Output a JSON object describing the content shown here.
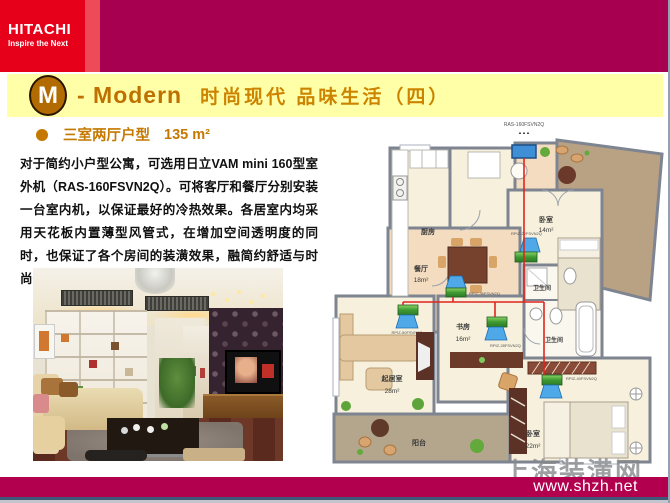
{
  "header": {
    "logo": {
      "brand": "HITACHI",
      "tagline": "Inspire the Next"
    },
    "badge_letter": "M",
    "title_en": "- Modern",
    "title_cn": "时尚现代 品味生活（四）"
  },
  "subtitle": {
    "label": "三室两厅户型",
    "area": "135 m²"
  },
  "paragraph": {
    "text": "对于简约小户型公寓，可选用日立VAM mini 160型室外机（RAS-160FSVN2Q）。可将客厅和餐厅分别安装一台室内机，以保证最好的冷热效果。各居室内均采用天花板内置薄型风管式，在增加空间透明度的同时，也保证了各个房间的装潢效果，融简约舒适与时尚于一体。"
  },
  "floorplan": {
    "rooms": {
      "kitchen": {
        "name": "厨房",
        "area": ""
      },
      "bedroom1": {
        "name": "卧室",
        "area": "14m²"
      },
      "dining": {
        "name": "餐厅",
        "area": "18m²"
      },
      "study": {
        "name": "书房",
        "area": "16m²"
      },
      "living": {
        "name": "起居室",
        "area": "28m²"
      },
      "bath1": {
        "name": "卫生间",
        "area": ""
      },
      "bath2": {
        "name": "卫生间",
        "area": ""
      },
      "bedroom2": {
        "name": "卧室",
        "area": "22m²"
      },
      "balcony": {
        "name": "阳台",
        "area": ""
      }
    },
    "units": {
      "outdoor": {
        "model": "RAS-160FSVN2Q",
        "arrows": "▲▲▲"
      },
      "bedroom1": "RPIZ-22FSVN2Q",
      "dining": "RPIZ-36FSVN2Q",
      "living": "RPIZ-50FSVN2Q",
      "study": "RPIZ-28FSVN2Q",
      "bedroom2": "RPIZ-40FSVN2Q"
    }
  },
  "footer": {
    "url": "www.shzh.net",
    "watermark": "上海装潢网"
  },
  "colors": {
    "hitachi_red": "#E60019",
    "accent_strip": "#EE4B58",
    "magenta_band": "#A80050",
    "title_band_yellow": "#FFFFA8",
    "title_orange": "#C47800",
    "footer_magenta": "#B2004F",
    "piping_red": "#E0251E",
    "indoor_unit_green": "#4CA83C",
    "unit_blue": "#3F8FD6"
  }
}
